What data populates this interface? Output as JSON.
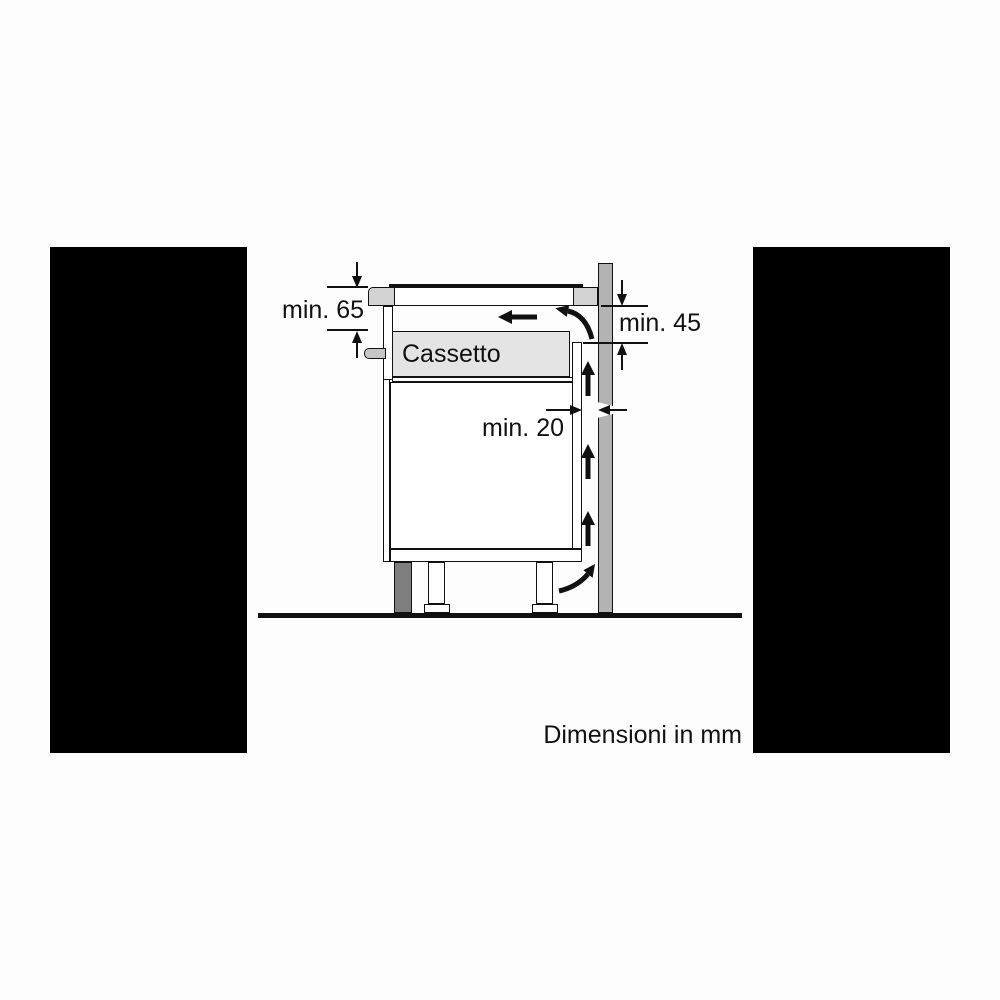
{
  "figure": {
    "drawer_label": "Cassetto",
    "footer_note": "Dimensioni in mm",
    "dimensions": {
      "hob_clearance": "min. 65",
      "worktop_to_vent": "min. 45",
      "rear_wall_gap": "min. 20"
    },
    "colors": {
      "wall": "#b3b3b3",
      "worktop": "#d2d2d2",
      "drawer": "#e4e4e4",
      "plinth": "#7e7e7e",
      "knob": "#c6c6c6",
      "line": "#111111",
      "mask": "#000000"
    }
  }
}
